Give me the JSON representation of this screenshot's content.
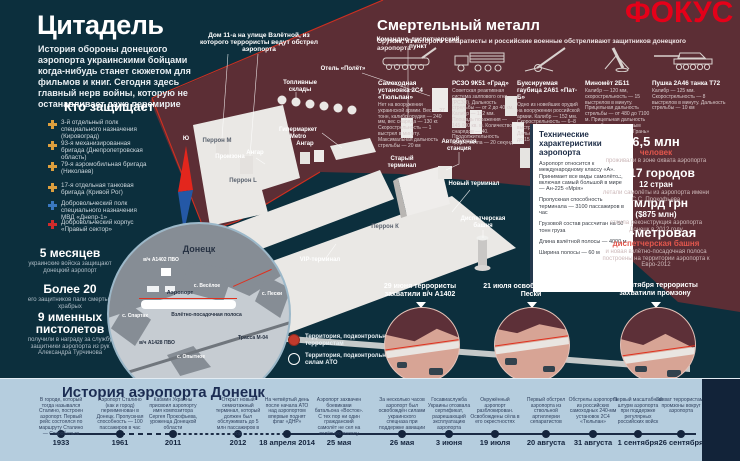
{
  "colors": {
    "background_teal": "#0c2f3d",
    "separatist_maroon": "#5c2e35",
    "logo_red": "#e50019",
    "accent_salmon": "#e2574d",
    "timeline_band": "#b5cdde"
  },
  "header": {
    "title": "Цитадель",
    "intro": "История обороны донецкого аэропорта украинскими бойцами когда-нибудь станет сюжетом для фильмов и книг. Сегодня здесь главный нерв войны, которую не останавливает даже перемирие",
    "logo": "ФОКУС"
  },
  "defenders": {
    "heading": "Кто защищает",
    "items": [
      {
        "text": "3-й отдельный полк специального назначения (Кировоград)"
      },
      {
        "text": "93-я механизированная бригада (Днепропетровская область)"
      },
      {
        "text": "79-я аэромобильная бригада (Николаев)"
      },
      {
        "text": "17-я отдельная танковая бригада (Кривой Рог)"
      },
      {
        "text": "Добровольческий полк специального назначения МВД «Днепр-1»"
      },
      {
        "text": "Добровольческий корпус «Правый сектор»"
      }
    ]
  },
  "left_stats": [
    {
      "value": "5 месяцев",
      "desc": "украинские войска защищают донецкий аэропорт"
    },
    {
      "value": "Более 20",
      "desc": "его защитников пали смертью храбрых"
    },
    {
      "value": "9 именных пистолетов",
      "desc": "получили в награду за службу защитники аэропорта из рук Александра Турчинова"
    }
  ],
  "weapons": {
    "heading": "Смертельный металл",
    "subheading": "Оружие, из которого сепаратисты и российские военные обстреливают защитников донецкого аэропорта",
    "items": [
      {
        "name": "Самоходная установка 2С4 «Тюльпан»",
        "desc": "Нет на вооружении украинской армии. Вес — 27 тонн, калибр орудия — 240 мм, вес снаряда — 130 кг. Скорострельность — 1 выстрел в минуту. Максимальная дальность стрельбы — 20 км"
      },
      {
        "name": "РСЗО 9К51 «Град»",
        "desc": "Советская реактивная система залпового огня (РСЗО). Дальность стрельбы — от 2 до 40 км. Калибр — 122 мм. Площадь поражения — 145 000 кв. м. Количество снарядов — 40. Продолжительность одного залпа — 20 секунд"
      },
      {
        "name": "Буксируемая гаубица 2А61 «Пат-Б»",
        "desc": "Одно из новейших орудий на вооружении российской армии. Калибр — 152 мм. Скорострельность — 6–8 выстрелов в минуту. Дальность стрельбы — от 4 до 15 км"
      },
      {
        "name": "Миномёт 2Б11",
        "desc": "Калибр — 120 мм, скорострельность — 15 выстрелов в минуту. Прицельная дальность стрельбы — от 480 до 7100 м. Прицельная дальность стрельбы управляемым боеприпасом КМ-8 «Грань» — 9 км"
      },
      {
        "name": "Пушка 2А46 танка Т72",
        "desc": "Калибр — 125 мм. Скорострельность — 8 выстрелов в минуту. Дальность стрельбы — 10 км"
      }
    ]
  },
  "map": {
    "callouts": {
      "house": "Дом 11-а на улице Взлётной, из которого террористы ведут обстрел аэропорта",
      "command": "Командно-диспетчерский пункт"
    },
    "labels": {
      "hotel": "Отель «Полёт»",
      "fuel": "Топливные склады",
      "metro": "Гипермаркет Metro",
      "perron_m": "Перрон М",
      "perron_l": "Перрон L",
      "perron_k": "Перрон К",
      "promzona": "Промзона",
      "hangar_a": "Ангар",
      "hangar_b": "Ангар",
      "old_terminal": "Старый терминал",
      "new_terminal": "Новый терминал",
      "bus_station": "Автобусная станция",
      "tower": "Диспетчерская башня",
      "vip": "VIP-терминал",
      "compass_south": "Ю",
      "compass_north": "С"
    },
    "legend": [
      {
        "label": "Территория, подконтрольная террористам"
      },
      {
        "label": "Территория, подконтрольная силам АТО"
      }
    ]
  },
  "city_inset": {
    "labels": {
      "city": "Донецк",
      "unit_a1402": "в/ч А1402 ПВО",
      "veseloe": "с. Весёлое",
      "peski": "с. Пески",
      "airport": "Аэропорт",
      "runway": "Взлётно-посадочная полоса",
      "spartak": "с. Спартак",
      "unit_a1428": "в/ч А1428 ПВО",
      "opytnoe": "с. Опытное",
      "highway": "Трасса М-04"
    }
  },
  "tech_box": {
    "title": "Технические характеристики аэропорта",
    "paragraphs": [
      "Аэропорт относится к международному классу «А». Принимает все виды самолётов, включая самый большой в мире — Ан-225 «Мрія»",
      "Пропускная способность терминала — 3100 пассажиров в час",
      "Грузовой состав рассчитан на 50 тонн груза",
      "Длина взлётной полосы — 4000 м",
      "Ширина полосы — 60 м"
    ]
  },
  "right_stats": [
    {
      "value": "6,5 млн",
      "accent": "человек",
      "desc": "проживали в зоне охвата аэропорта"
    },
    {
      "value": "В 17 городов",
      "accent": "12 стран",
      "desc": "летали самолёты из аэропорта имени С.С. Прокофьева"
    },
    {
      "value": "7 млрд грн",
      "accent": "($875 млн)",
      "desc": "стоила реконструкция аэропорта Донецк в 2012 году"
    },
    {
      "value": "45-метровая",
      "accent": "диспетчерская башня",
      "desc": "и новая взлётно-посадочная полоса построены на территории аэропорта к Евро-2012"
    }
  ],
  "events": [
    {
      "title": "29 июня террористы захватили в/ч А1402"
    },
    {
      "title": "21 июля освобождено село Пески"
    },
    {
      "title": "26 сентября террористы захватили промзону"
    }
  ],
  "timeline": {
    "title": "История аэропорта Донецк",
    "milestones": [
      {
        "date": "1933",
        "desc": "В городе, который тогда назывался Сталино, построен аэропорт. Первый рейс состоялся по маршруту Сталино — Старобельск"
      },
      {
        "date": "1961",
        "desc": "Аэропорт Сталино (как и город) переименован в Донецк. Пропускная способность — 100 пассажиров в час"
      },
      {
        "date": "2011",
        "desc": "Кабмин Украины присвоил аэропорту имя композитора Сергея Прокофьева, уроженца Донецкой области"
      },
      {
        "date": "2012",
        "desc": "Открыт новый семиэтажный терминал, который должен был обслуживать до 5 млн пассажиров в год"
      },
      {
        "date": "18 апреля 2014",
        "desc": "На четвёртый день после начала АТО над аэропортом впервые поднят флаг «ДНР»"
      },
      {
        "date": "25 мая",
        "desc": "Аэропорт захвачен боевиками батальона «Восток». С тех пор ни один гражданский самолёт не сел на взлётную полосу"
      },
      {
        "date": "26 мая",
        "desc": "За несколько часов аэропорт был освобождён силами украинского спецназа при поддержке авиации"
      },
      {
        "date": "3 июня",
        "desc": "Госавиаслужба Украины отозвала сертификат, разрешающий эксплуатацию аэропорта"
      },
      {
        "date": "19 июля",
        "desc": "Окружённый аэропорт разблокирован. Освобождены сёла в его окрестностях"
      },
      {
        "date": "20 августа",
        "desc": "Первый обстрел аэропорта из ствольной артиллерии сепаратистов"
      },
      {
        "date": "31 августа",
        "desc": "Обстрелы аэропорта из российских самоходных 240-мм установок 2С4 «Тюльпан»"
      },
      {
        "date": "1 сентября",
        "desc": "Первый масштабный штурм аэропорта при поддержке регулярных российских войск"
      },
      {
        "date": "26 сентября",
        "desc": "Захват террористами промзоны вокруг аэропорта"
      }
    ]
  }
}
